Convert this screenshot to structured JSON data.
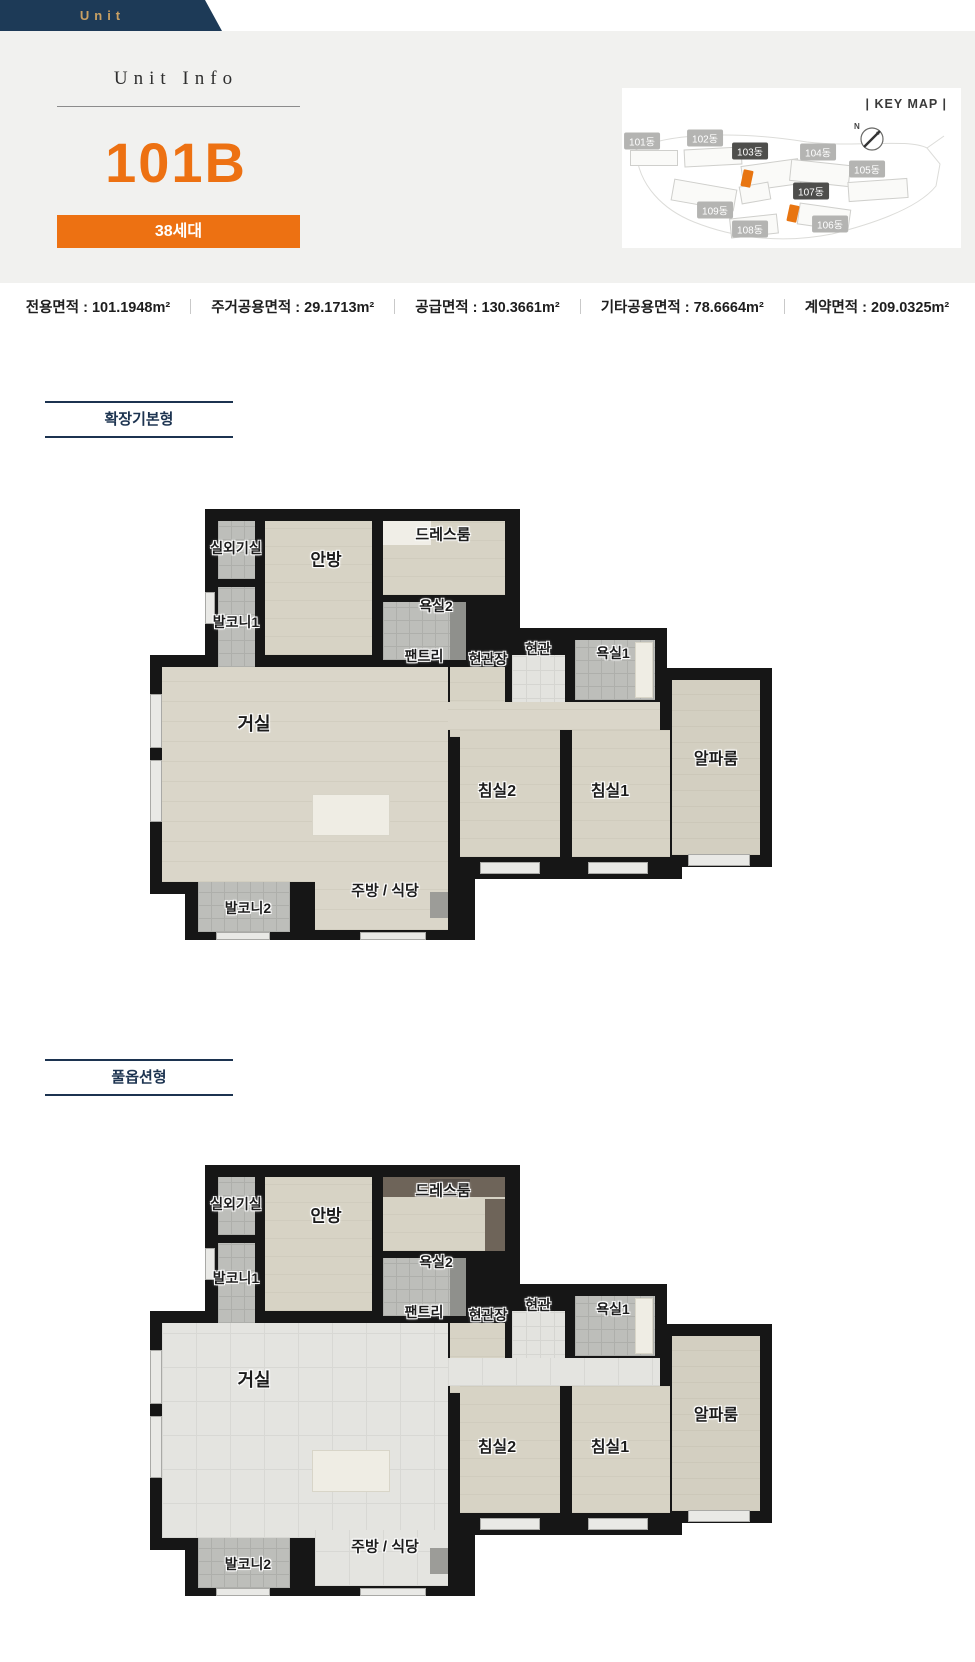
{
  "header_tab": {
    "label": "Unit"
  },
  "unit_info": {
    "heading": "Unit Info",
    "unit_code": "101B",
    "households_badge": "38세대",
    "accent_color": "#ED7112"
  },
  "key_map": {
    "title": "|  KEY MAP  |",
    "compass_label": "N",
    "highlight_color": "#E87511",
    "buildings": [
      {
        "label": "101동",
        "variant": "light",
        "x": 20,
        "y": 53
      },
      {
        "label": "102동",
        "variant": "light",
        "x": 83,
        "y": 50
      },
      {
        "label": "103동",
        "variant": "dark",
        "x": 128,
        "y": 63
      },
      {
        "label": "104동",
        "variant": "light",
        "x": 196,
        "y": 64
      },
      {
        "label": "105동",
        "variant": "light",
        "x": 245,
        "y": 81
      },
      {
        "label": "107동",
        "variant": "dark",
        "x": 189,
        "y": 103
      },
      {
        "label": "109동",
        "variant": "light",
        "x": 93,
        "y": 122
      },
      {
        "label": "108동",
        "variant": "light",
        "x": 128,
        "y": 141
      },
      {
        "label": "106동",
        "variant": "light",
        "x": 208,
        "y": 136
      }
    ],
    "highlight_marks": [
      {
        "near": "103동",
        "x": 120,
        "y": 82
      },
      {
        "near": "107동",
        "x": 166,
        "y": 117
      }
    ]
  },
  "area_info": {
    "separator": "|",
    "items": [
      {
        "label": "전용면적",
        "value": "101.1948m²"
      },
      {
        "label": "주거공용면적",
        "value": "29.1713m²"
      },
      {
        "label": "공급면적",
        "value": "130.3661m²"
      },
      {
        "label": "기타공용면적",
        "value": "78.6664m²"
      },
      {
        "label": "계약면적",
        "value": "209.0325m²"
      }
    ]
  },
  "floor_sections": [
    {
      "id": "basic",
      "label": "확장기본형"
    },
    {
      "id": "full",
      "label": "풀옵션형"
    }
  ],
  "rooms": [
    {
      "id": "outdoor-unit",
      "label": "실외기실"
    },
    {
      "id": "balcony1",
      "label": "발코니1"
    },
    {
      "id": "master-bedroom",
      "label": "안방"
    },
    {
      "id": "dress-room",
      "label": "드레스룸"
    },
    {
      "id": "bath2",
      "label": "욕실2"
    },
    {
      "id": "pantry",
      "label": "팬트리"
    },
    {
      "id": "entry-closet",
      "label": "현관장"
    },
    {
      "id": "entry",
      "label": "현관"
    },
    {
      "id": "bath1",
      "label": "욕실1"
    },
    {
      "id": "living-room",
      "label": "거실"
    },
    {
      "id": "bedroom2",
      "label": "침실2"
    },
    {
      "id": "bedroom1",
      "label": "침실1"
    },
    {
      "id": "alpha-room",
      "label": "알파룸"
    },
    {
      "id": "balcony2",
      "label": "발코니2"
    },
    {
      "id": "kitchen-dining",
      "label": "주방 / 식당"
    }
  ]
}
